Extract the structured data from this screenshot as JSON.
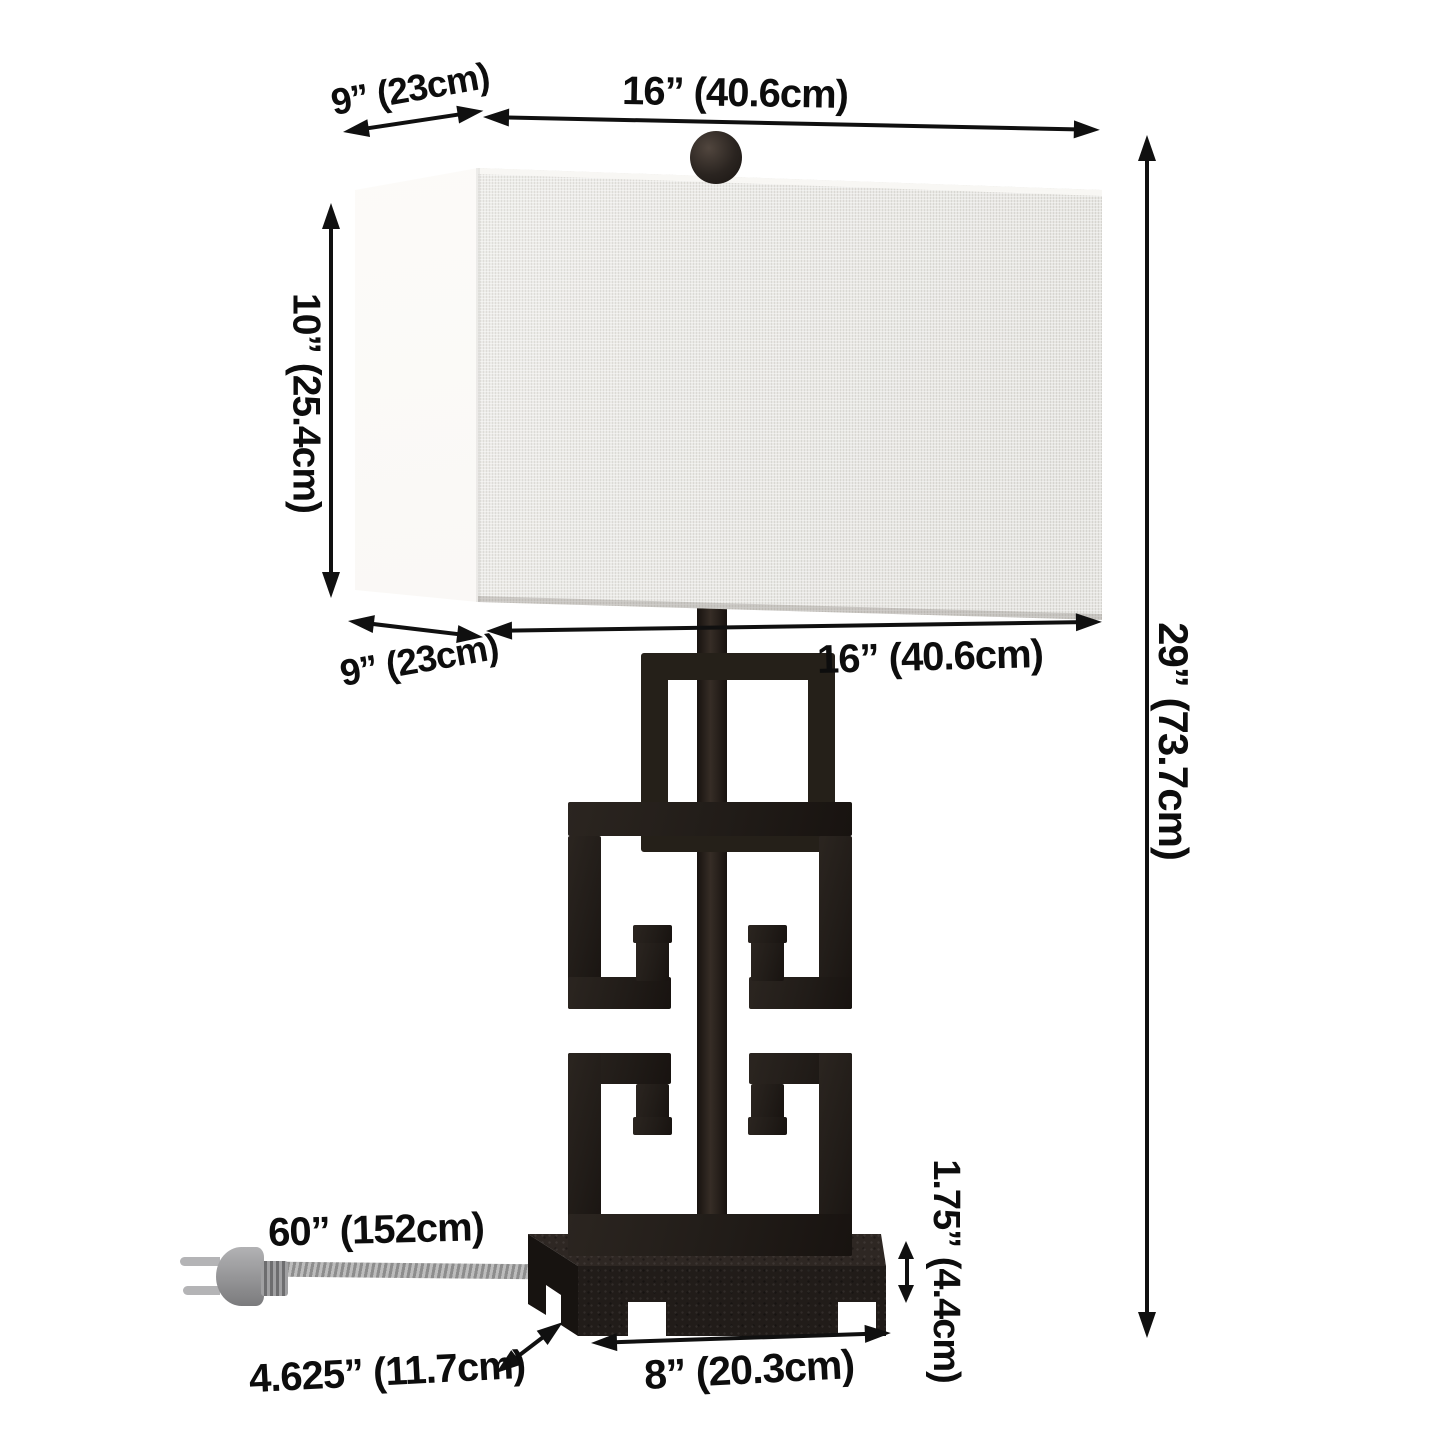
{
  "diagram": {
    "kind": "product-dimension-diagram",
    "product": "greek-key table lamp with rectangular shade",
    "background": "#ffffff"
  },
  "labels": {
    "shade_depth_top": "9” (23cm)",
    "shade_width_top": "16” (40.6cm)",
    "shade_height": "10” (25.4cm)",
    "shade_depth_bottom": "9” (23cm)",
    "shade_width_bottom": "16” (40.6cm)",
    "total_height": "29” (73.7cm)",
    "cord_length": "60” (152cm)",
    "base_depth": "4.625” (11.7cm)",
    "base_width": "8” (20.3cm)",
    "base_height": "1.75” (4.4cm)"
  },
  "colors": {
    "annotation": "#101010",
    "lamp_metal": "#231e1a",
    "shade_side": "#fbfaf8",
    "shade_front": "#ecebe7",
    "cord_gray": "#9e9e9e",
    "plug_gray": "#8f8f92"
  }
}
